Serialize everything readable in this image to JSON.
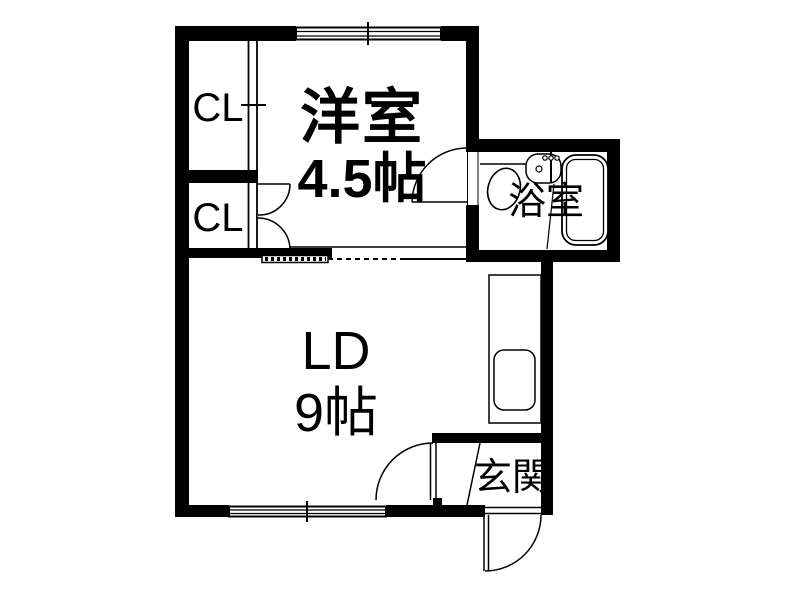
{
  "plan": {
    "rooms": {
      "western": {
        "name": "洋室",
        "size": "4.5帖"
      },
      "closet_upper": {
        "name": "CL"
      },
      "closet_lower": {
        "name": "CL"
      },
      "bath": {
        "name": "浴室"
      },
      "living_dining": {
        "name": "LD",
        "size": "9帖"
      },
      "entrance": {
        "name": "玄関"
      }
    },
    "colors": {
      "wall": "#000000",
      "background": "#ffffff",
      "line": "#000000"
    }
  }
}
